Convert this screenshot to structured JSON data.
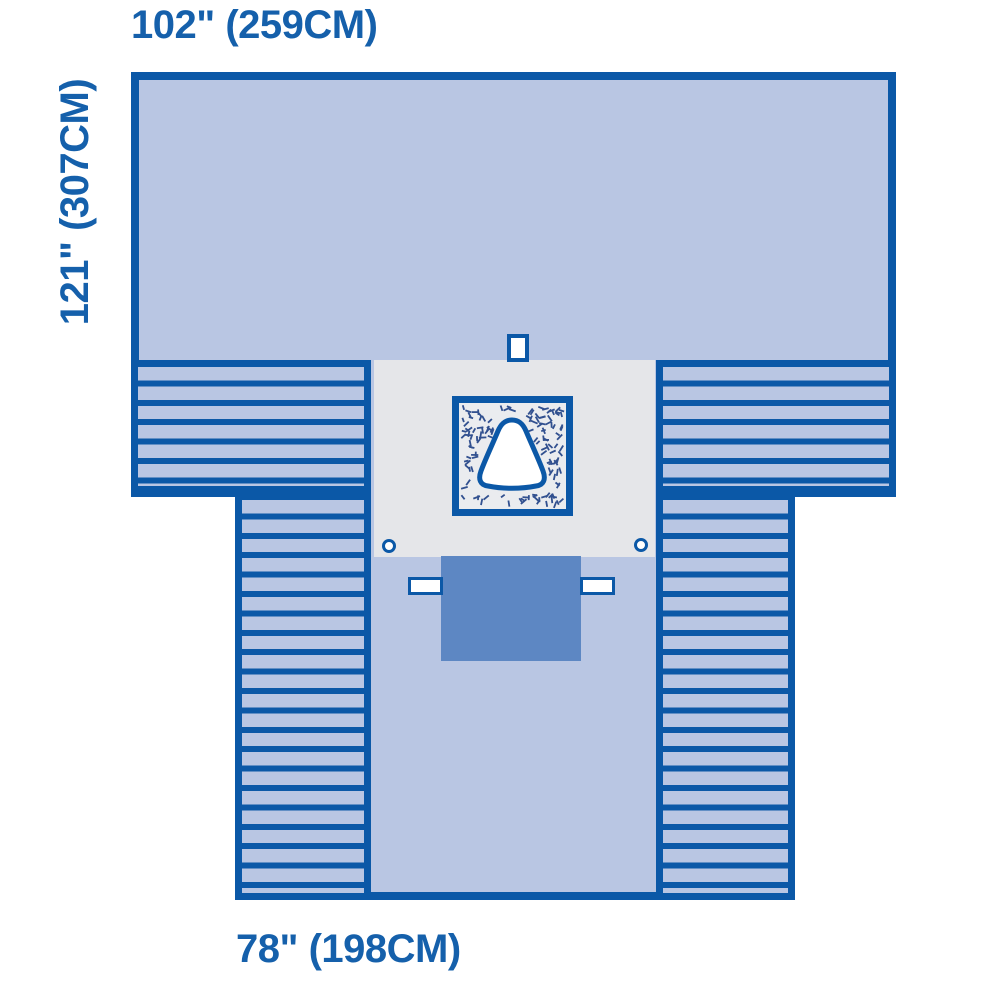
{
  "figure": {
    "type": "surgical-drape-dimension-diagram",
    "labels": {
      "top": "102\" (259CM)",
      "left": "121\" (307CM)",
      "bottom": "78\" (198CM)"
    }
  },
  "colors": {
    "line": "#0b58a7",
    "drape": "#b9c6e3",
    "reinforcement": "#e5e6e9",
    "incise": "#eaecef",
    "pouch": "#5d87c3",
    "text": "#1560ab",
    "speckle": "#31508f",
    "white": "#ffffff"
  }
}
